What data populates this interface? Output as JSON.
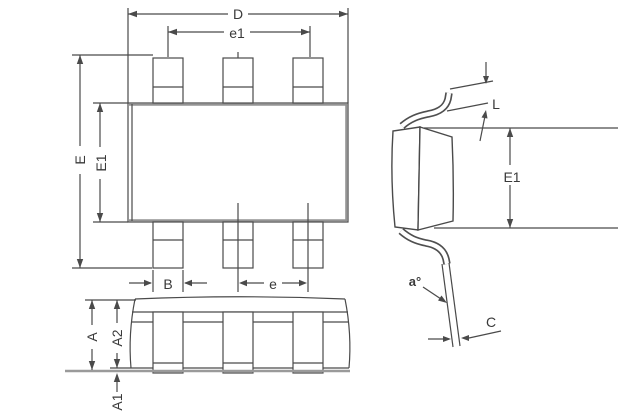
{
  "figure": {
    "views": {
      "top": {
        "dims": {
          "D": "D",
          "e1": "e1",
          "E": "E",
          "E1": "E1",
          "B": "B",
          "e": "e"
        }
      },
      "front": {
        "dims": {
          "A": "A",
          "A2": "A2",
          "A1": "A1"
        }
      },
      "side": {
        "dims": {
          "L": "L",
          "E1": "E1",
          "alpha": "a°",
          "C": "C"
        }
      }
    },
    "colors": {
      "line": "#4a4a4a",
      "thick_edge": "#949494",
      "background": "#ffffff"
    }
  }
}
